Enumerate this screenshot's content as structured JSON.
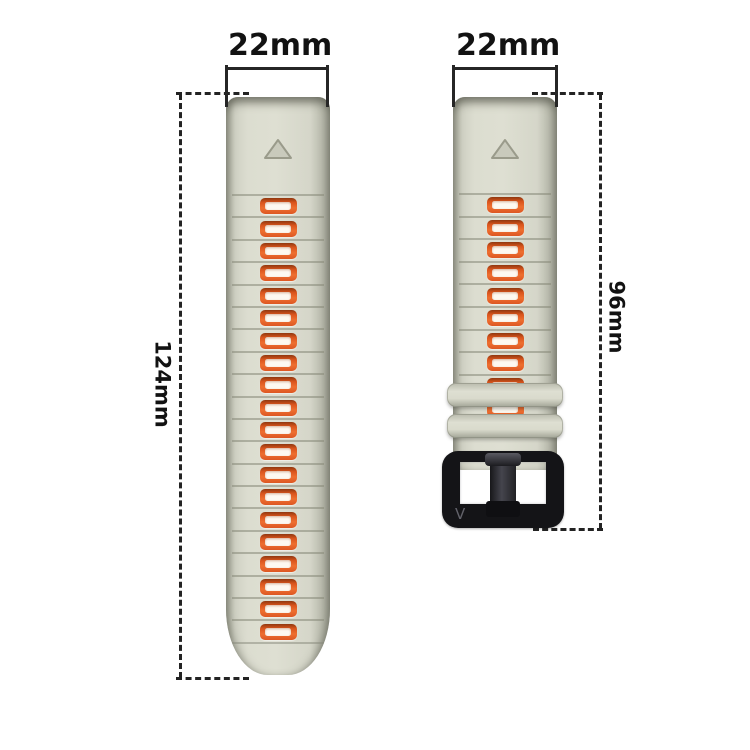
{
  "image": {
    "kind": "watch-band-size-diagram",
    "background": "#ffffff"
  },
  "annotations": {
    "left_strap_width": "22mm",
    "right_strap_width": "22mm",
    "left_strap_length": "124mm",
    "right_strap_length": "96mm"
  },
  "straps": {
    "left": {
      "segment_count": 20,
      "marker": "triangle-up"
    },
    "right": {
      "segment_count": 10,
      "marker": "triangle-up",
      "keeper_count": 2,
      "buckle_engraving": "V"
    }
  },
  "colors": {
    "strap_body": "#dcddd0",
    "strap_edge": "#a7a99b",
    "groove_line": "#868879",
    "segment_orange": "#e2581f",
    "segment_inner": "#fdf9f1",
    "buckle_black": "#141417",
    "dimension_line": "#262626"
  }
}
